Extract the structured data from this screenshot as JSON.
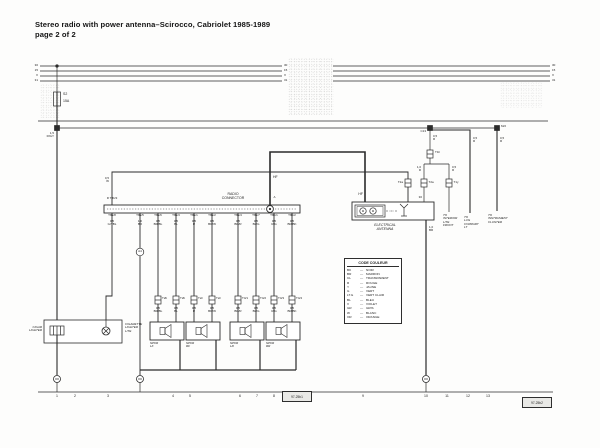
{
  "title": {
    "line1": "Stereo radio with power antenna–Scirocco, Cabriolet 1985-1989",
    "line2": "page 2 of 2"
  },
  "bus": {
    "labels_left": [
      "30",
      "15",
      "X",
      "31"
    ],
    "labels_mid": [
      "30",
      "15",
      "X",
      "31"
    ],
    "labels_right": [
      "30",
      "15",
      "X",
      "31"
    ]
  },
  "fuse": {
    "name": "S2",
    "rating": "15A"
  },
  "feed_wire": "1,5\nR/GY",
  "junctions": {
    "c13": "C13",
    "m2": "M/2"
  },
  "radio": {
    "connector_label": "RADIO\nCONNECTOR",
    "top_pin": "R  T8b/3",
    "top_wire": "0,5\nW",
    "hf_label": "HF",
    "hf_label2": "HF",
    "a_label": "A",
    "splice": "A4",
    "pins": [
      "T8a/8",
      "T8a/5",
      "T8a/6",
      "T8a/3",
      "T8a/1",
      "T8a/2",
      "T8a/4",
      "T8a/7",
      "T8b/1",
      "T8b/2"
    ],
    "wire_labels": [
      "0,5\nGY/BL",
      "1,0\nBR",
      "0,5\nBR/BL",
      "0,5\nBL",
      "0,5\nR",
      "0,5\nBR/W",
      "0,5\nBR/R",
      "0,5\nBL/G",
      "0,5\nR/G",
      "0,5\nBR/BK"
    ]
  },
  "speakers": {
    "connectors": [
      "T2b",
      "T2b",
      "T2c",
      "T2c",
      "T4/1",
      "T4/2",
      "T4/3",
      "T4/4"
    ],
    "wire_labels": [
      "0,5\nBR/BL",
      "0,5\nBL",
      "0,5\nR",
      "0,5\nBR/W",
      "0,5\nBR/R",
      "0,5\nBL/G",
      "0,5\nR/G",
      "0,5\nBR/BK"
    ],
    "names": [
      "SPKR\nLF",
      "SPKR\nRF",
      "SPKR\nLR",
      "SPKR\nRR"
    ]
  },
  "lighter": {
    "left_label": "CIGAR\nLIGHTER",
    "right_label": "CIGARETTE\nLIGHTER\nLITE"
  },
  "antenna": {
    "name": "ELECTRICAL\nANTENNA",
    "pin30": "30",
    "w1": "0,5\nR",
    "w2": "1,0\nR",
    "w3": "0,5\nR",
    "w4": "0,5\nR",
    "w5": "0,5\nR",
    "ground": "1,0\nBR",
    "t1h": "T1h",
    "t2a_1": "T2a",
    "t2a_2": "T2a",
    "t1y": "T1y",
    "to_interior": "TO\nINTERIOR\nLITE\nFRONT",
    "to_lug": "TO\nLUG\nCOMPART\nLT",
    "to_cluster": "TO\nINSTRUMENT\nCLUSTER"
  },
  "legend": {
    "title": "CODE COULEUR",
    "dash": "—",
    "entries": [
      {
        "code": "BK",
        "name": "NOIR"
      },
      {
        "code": "BR",
        "name": "MARRON"
      },
      {
        "code": "CL",
        "name": "TRANSPARENT"
      },
      {
        "code": "R",
        "name": "ROUGE"
      },
      {
        "code": "Y",
        "name": "JAUNE"
      },
      {
        "code": "G",
        "name": "VERT"
      },
      {
        "code": "LT.G",
        "name": "VERT CLAIR"
      },
      {
        "code": "BL",
        "name": "BLEU"
      },
      {
        "code": "V",
        "name": "VIOLET"
      },
      {
        "code": "GR",
        "name": "GRIS"
      },
      {
        "code": "W",
        "name": "BLANC"
      },
      {
        "code": "OR",
        "name": "ORANGE"
      }
    ]
  },
  "tracks": {
    "left": [
      "1",
      "2",
      "3",
      "4",
      "5",
      "6",
      "7",
      "8"
    ],
    "right": [
      "9",
      "10",
      "11",
      "12",
      "13"
    ]
  },
  "diagram_ids": {
    "left": "97-25b1",
    "right": "97-25b2"
  },
  "colors": {
    "ink": "#2b2b2b",
    "paper": "#fdfdfc"
  }
}
